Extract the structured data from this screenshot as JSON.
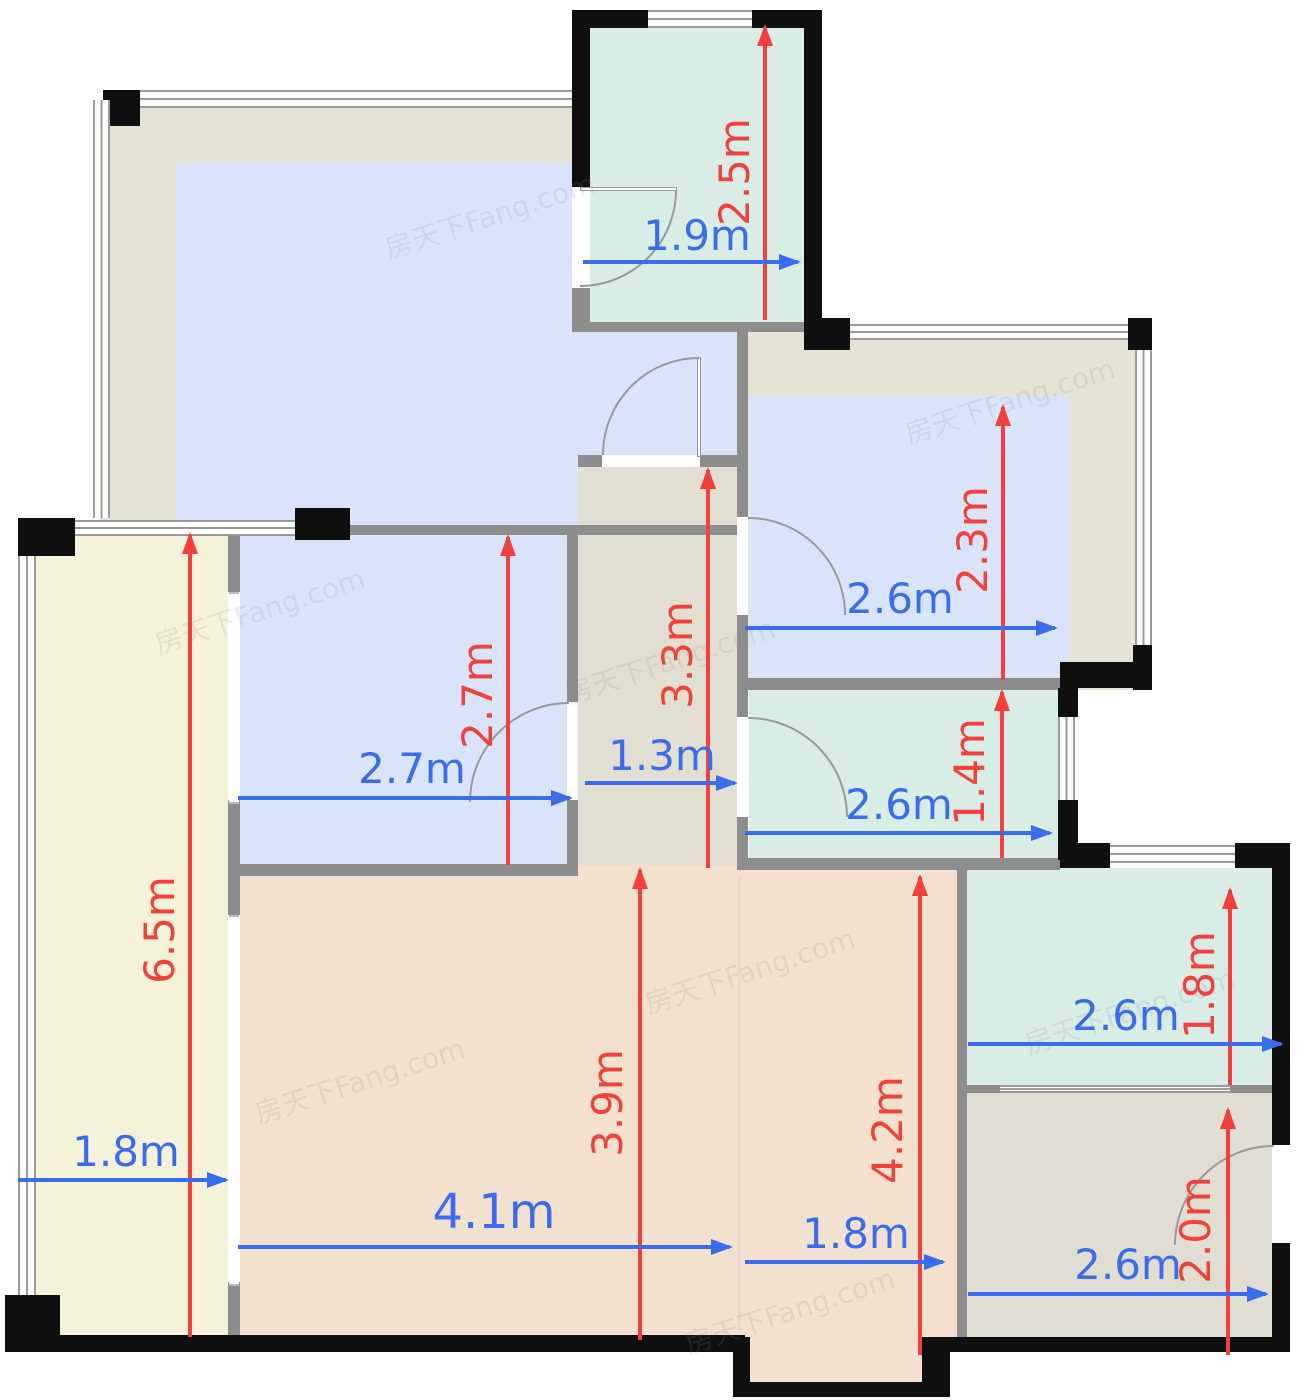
{
  "watermark": {
    "text": "房天下Fang.com"
  },
  "colors": {
    "wall_black": "#0f0f0f",
    "wall_gray": "#8d8d8d",
    "window_line": "#9a9a9a",
    "door_line": "#999999",
    "beige_room": "#e5e3d3",
    "blue_room": "#d9e4fb",
    "teal_room": "#d9ece6",
    "yellow_room": "#f5f2da",
    "corridor_room": "#e0dfd2",
    "tan_room": "#f4e0ce",
    "gray_room": "#e0ded2",
    "red_arrow": "#f4403a",
    "blue_arrow": "#3a6cee"
  },
  "dims": {
    "red": [
      {
        "label": "2.5m"
      },
      {
        "label": "2.3m"
      },
      {
        "label": "2.7m"
      },
      {
        "label": "3.3m"
      },
      {
        "label": "1.4m"
      },
      {
        "label": "6.5m"
      },
      {
        "label": "3.9m"
      },
      {
        "label": "4.2m"
      },
      {
        "label": "1.8m"
      },
      {
        "label": "2.0m"
      }
    ],
    "blue": [
      {
        "label": "1.9m"
      },
      {
        "label": "2.6m"
      },
      {
        "label": "2.7m"
      },
      {
        "label": "1.3m"
      },
      {
        "label": "2.6m"
      },
      {
        "label": "1.8m"
      },
      {
        "label": "4.1m"
      },
      {
        "label": "2.6m"
      },
      {
        "label": "1.8m"
      },
      {
        "label": "2.6m"
      }
    ]
  }
}
